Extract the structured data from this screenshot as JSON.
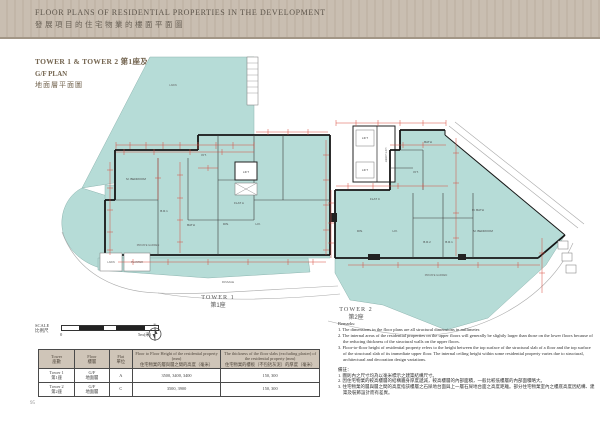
{
  "header": {
    "title_en": "FLOOR PLANS OF RESIDENTIAL PROPERTIES IN THE DEVELOPMENT",
    "title_zh": "發展項目的住宅物業的樓面平面圖"
  },
  "title_block": {
    "towers": "TOWER 1 & TOWER 2 第1座及第2座",
    "plan_en": "G/F PLAN",
    "plan_zh": "地面層平面圖"
  },
  "scale_bar": {
    "label_en": "SCALE",
    "label_zh": "比例尺",
    "start": "0",
    "end": "5m(米)",
    "north": "N"
  },
  "tower1": {
    "caption_en": "TOWER 1",
    "caption_zh": "第1座",
    "labels": {
      "lawn": "LAWN",
      "m_bedroom": "M. BEDROOM",
      "br1": "B.R.1",
      "bath": "BATH",
      "kit": "KIT.",
      "flat": "FLAT  A",
      "din": "DIN.",
      "liv": "LIV.",
      "lift": "LIFT",
      "private_garden": "PRIVATE GARDEN",
      "lawn_small": "LAWN",
      "planter": "PLANTER",
      "passage": "PASSAGE"
    }
  },
  "tower2": {
    "caption_en": "TOWER 2",
    "caption_zh": "第2座",
    "labels": {
      "lift1": "LIFT",
      "lift2": "LIFT",
      "lift_lobby": "LIFT LOBBY",
      "kit": "KIT.",
      "bath": "BATH",
      "flat": "FLAT  C",
      "din": "DIN.",
      "liv": "LIV.",
      "br2": "B.R.2",
      "br1": "B.R.1",
      "m_bedroom": "M. BEDROOM",
      "m_bath": "M. BATH",
      "private_garden": "PRIVATE GARDEN"
    }
  },
  "table": {
    "headers": {
      "tower_en": "Tower",
      "tower_zh": "座數",
      "floor_en": "Floor",
      "floor_zh": "樓層",
      "flat_en": "Flat",
      "flat_zh": "單位",
      "height_en": "Floor to Floor Height of the residential property (mm)",
      "height_zh": "住宅物業的層與層之間的高度（毫米）",
      "thickness_en": "The thickness of the floor slabs (excluding plaster) of the residential property (mm)",
      "thickness_zh": "住宅物業的樓板（不包括灰泥）的厚度（毫米）"
    },
    "rows": [
      {
        "tower_en": "Tower 1",
        "tower_zh": "第1座",
        "floor_en": "G/F",
        "floor_zh": "地面層",
        "flat": "A",
        "height": "3500, 3400, 3400",
        "thickness": "150, 300"
      },
      {
        "tower_en": "Tower 2",
        "tower_zh": "第2座",
        "floor_en": "G/F",
        "floor_zh": "地面層",
        "flat": "C",
        "height": "3500, 3900",
        "thickness": "150, 300"
      }
    ]
  },
  "remarks": {
    "en_title": "Remarks:",
    "en1": "1. The dimensions in the floor plans are all structural dimensions in millimeter.",
    "en2": "2. The internal areas of the residential properties on the upper floors will generally be slightly larger than those on the lower floors because of the reducing thickness of the structural walls on the upper floors.",
    "en3": "3. Floor-to-floor height of residential property refers to the height between the top surface of the structural slab of a floor and the top surface of the structural slab of its immediate upper floor. The internal ceiling height within some residential property varies due to structural, architectural and decoration design variations.",
    "zh_title": "備註：",
    "zh1": "1. 圖則內之尺寸均為以毫米標示之建築結構尺寸。",
    "zh2": "2. 因住宅物業的較高樓層的結構牆身厚度遞減，較高樓層的內部面積，一般比較低樓層的內部面積略大。",
    "zh3": "3. 住宅物業的層與層之間的高度指該樓層之石屎地台面與上一層石屎地台面之高度距離。部分住宅物業室內之樓底高度因結構、建築及裝飾設計而有差異。"
  },
  "page_number": "95"
}
